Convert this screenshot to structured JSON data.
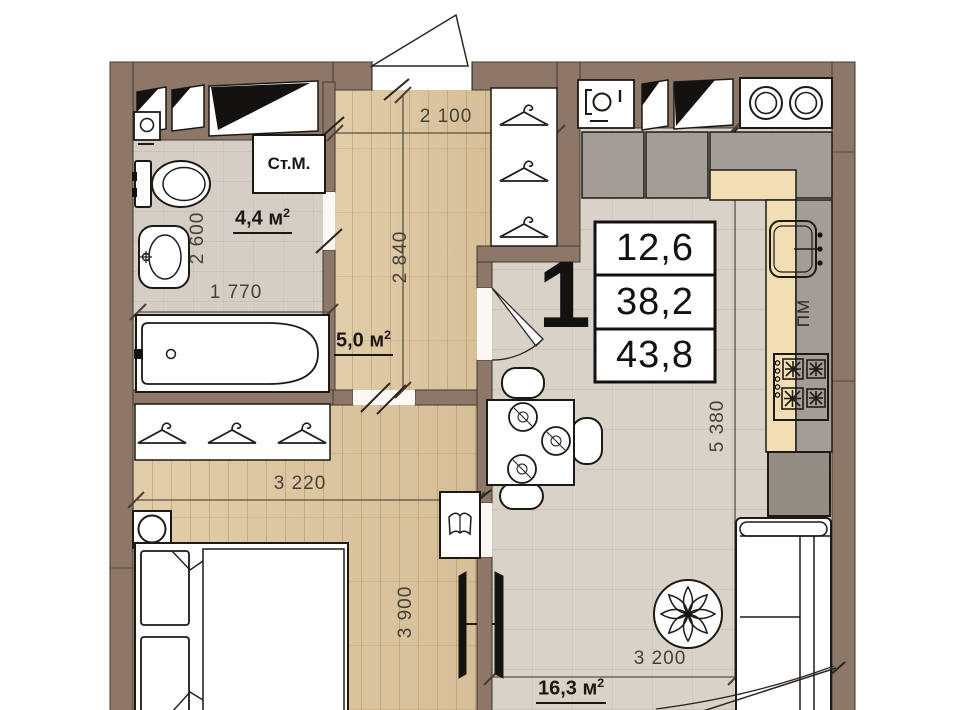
{
  "plan": {
    "kind": "apartment-floor-plan",
    "unit_table": {
      "number": "1",
      "rows": {
        "r1": "12,6",
        "r2": "38,2",
        "r3": "43,8"
      }
    },
    "areas": {
      "bathroom": {
        "value": "4,4",
        "unit": "м",
        "sup": "2"
      },
      "hallway": {
        "value": "5,0",
        "unit": "м",
        "sup": "2"
      },
      "living": {
        "value": "16,3",
        "unit": "м",
        "sup": "2"
      }
    },
    "labels": {
      "washing_machine": "Ст.М.",
      "dishwasher": "ПМ"
    },
    "dims": {
      "hall_width": "2 100",
      "hall_depth": "2 840",
      "bath_depth": "2 600",
      "bath_width": "1 770",
      "bedroom_width": "3 220",
      "bedroom_depth": "3 900",
      "kitchen_depth": "5 380",
      "kitchen_width": "3 200"
    },
    "icons": {
      "vent_shaft": "vent-shaft-icon",
      "washing_machine": "washing-machine-icon",
      "cooktop": "cooktop-icon",
      "kitchen_sink": "kitchen-sink-icon",
      "stove": "stove-burners-icon",
      "hanger": "hanger-icon",
      "toilet": "toilet-icon",
      "basin": "wash-basin-icon",
      "bathtub": "bathtub-icon",
      "plate": "dining-plate-icon",
      "book": "open-book-icon",
      "tv": "tv-icon",
      "plant": "plant-icon",
      "door_swing": "door-swing-icon"
    },
    "colors": {
      "wall": "#8d7769",
      "wood_floor": "#dcc7a2",
      "tile_floor": "#d9d2c8",
      "counter": "#f2deb4",
      "cabinet": "#a39d98",
      "line": "#1d1a16"
    }
  }
}
